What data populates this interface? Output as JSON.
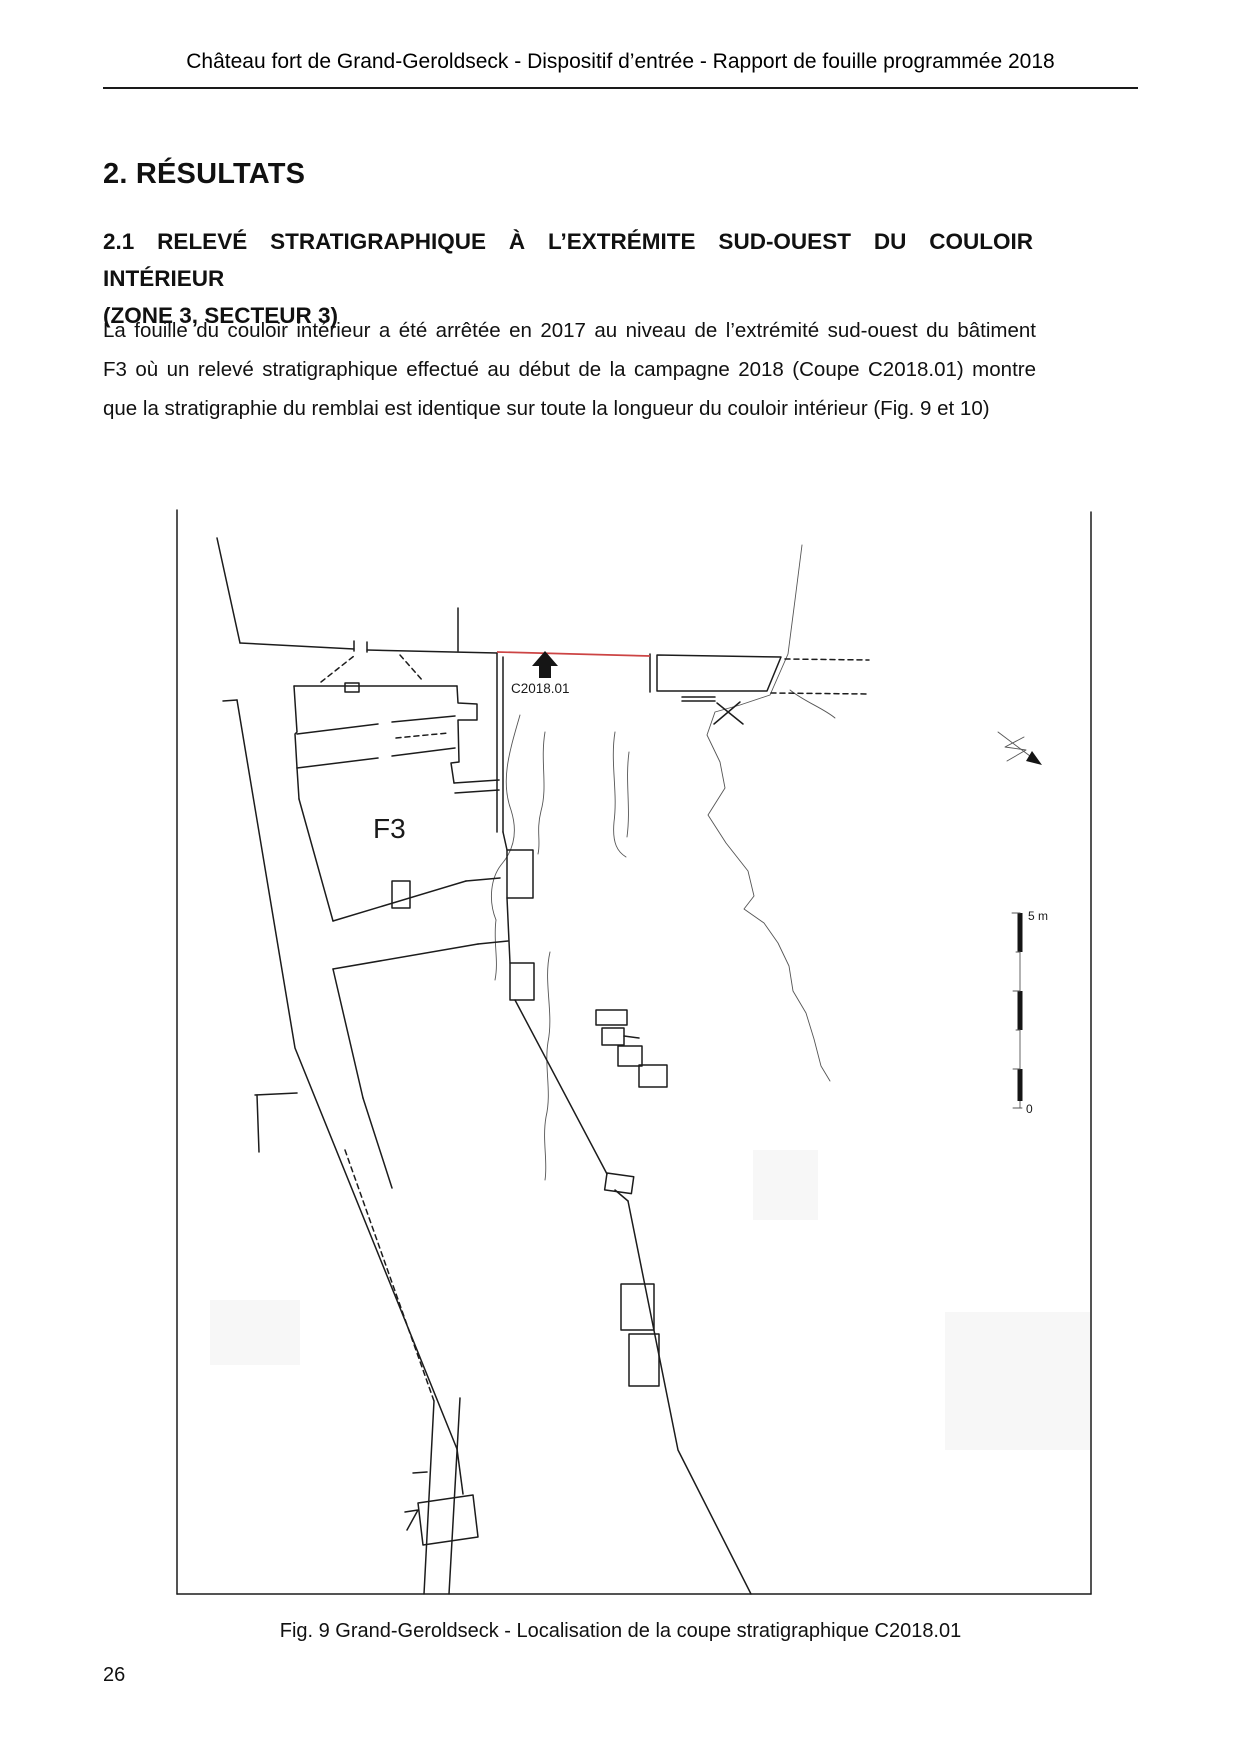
{
  "header": {
    "title": "Château fort de Grand-Geroldseck - Dispositif d’entrée - Rapport de fouille programmée 2018"
  },
  "section": {
    "title": "2. RÉSULTATS"
  },
  "subsection": {
    "lines": [
      "2.1 RELEVÉ STRATIGRAPHIQUE À L’EXTRÉMITE SUD-OUEST DU COULOIR INTÉRIEUR",
      "(ZONE 3, SECTEUR 3)"
    ]
  },
  "paragraph": {
    "lines": [
      "La fouille du couloir intérieur a été arrêtée en 2017 au niveau de l’extrémité sud-ouest du bâtiment",
      "F3 où un relevé stratigraphique effectué au début de la campagne 2018 (Coupe C2018.01) montre",
      "que la stratigraphie du remblai est identique sur toute la longueur du couloir intérieur (Fig. 9 et 10)"
    ]
  },
  "figure": {
    "labels": {
      "section_cut": "C2018.01",
      "building": "F3",
      "scale_top": "5 m",
      "scale_bottom": "0"
    },
    "colors": {
      "section_line": "#cc4444",
      "ink": "#1c1c1c"
    },
    "caption": "Fig. 9 Grand-Geroldseck - Localisation de la coupe stratigraphique C2018.01"
  },
  "footer": {
    "page_number": "26"
  }
}
